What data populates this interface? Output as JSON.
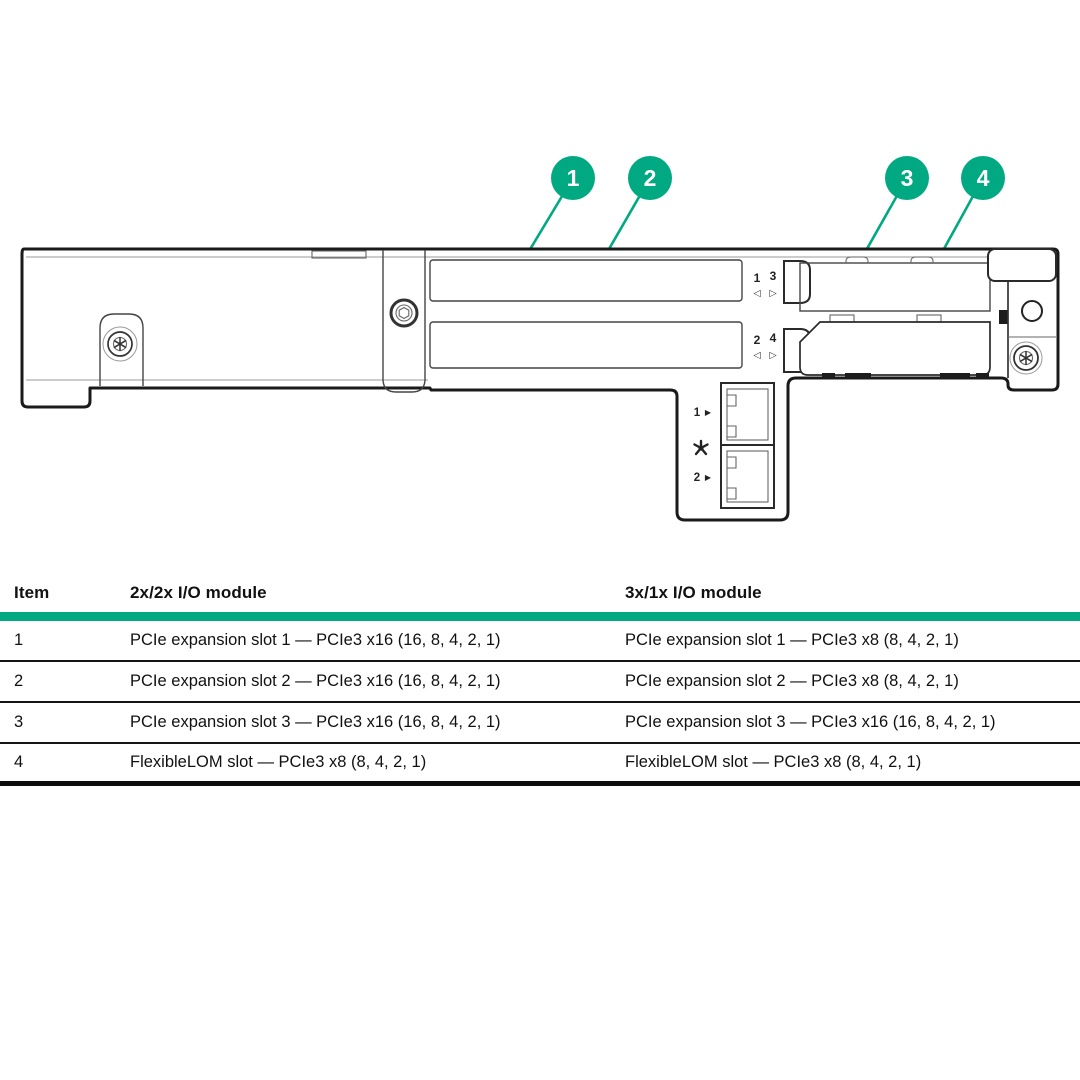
{
  "colors": {
    "accent": "#01A982",
    "line": "#1a1a1a"
  },
  "diagram": {
    "callouts": [
      {
        "label": "1"
      },
      {
        "label": "2"
      },
      {
        "label": "3"
      },
      {
        "label": "4"
      }
    ],
    "indicators": {
      "top": {
        "left_num": "1",
        "right_num": "3",
        "left_arrow": "◁",
        "right_arrow": "▷"
      },
      "bottom": {
        "left_num": "2",
        "right_num": "4",
        "left_arrow": "◁",
        "right_arrow": "▷"
      }
    },
    "nic": {
      "port1": "1",
      "port2": "2",
      "arrow": "▶"
    }
  },
  "table": {
    "columns": [
      "Item",
      "2x/2x I/O module",
      "3x/1x I/O module"
    ],
    "rows": [
      {
        "item": "1",
        "module_2x2x": "PCIe expansion slot 1 — PCIe3 x16 (16, 8, 4, 2, 1)",
        "module_3x1x": "PCIe expansion slot 1 — PCIe3 x8 (8, 4, 2, 1)"
      },
      {
        "item": "2",
        "module_2x2x": "PCIe expansion slot 2 — PCIe3 x16 (16, 8, 4, 2, 1)",
        "module_3x1x": "PCIe expansion slot 2 — PCIe3 x8 (8, 4, 2, 1)"
      },
      {
        "item": "3",
        "module_2x2x": "PCIe expansion slot 3 — PCIe3 x16 (16, 8, 4, 2, 1)",
        "module_3x1x": "PCIe expansion slot 3 — PCIe3 x16 (16, 8, 4, 2, 1)"
      },
      {
        "item": "4",
        "module_2x2x": "FlexibleLOM slot — PCIe3 x8 (8, 4, 2, 1)",
        "module_3x1x": "FlexibleLOM slot — PCIe3 x8 (8, 4, 2, 1)"
      }
    ]
  }
}
